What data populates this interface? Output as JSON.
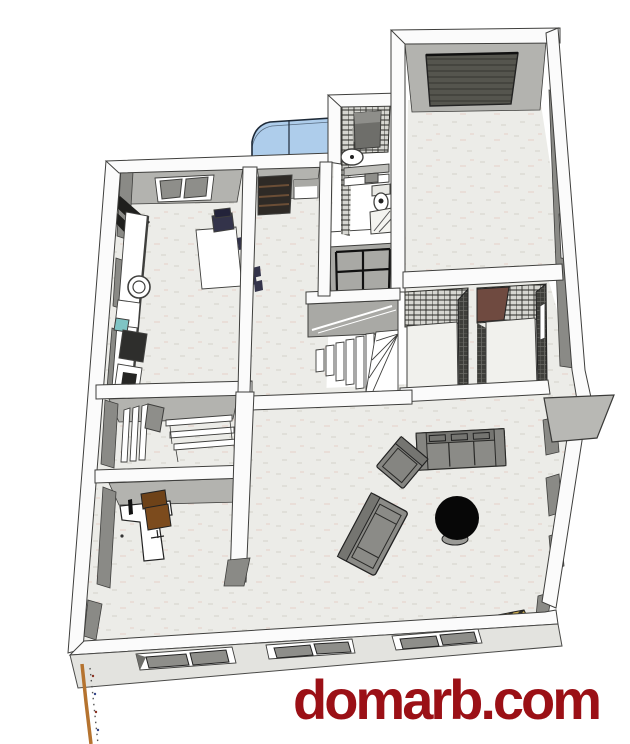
{
  "watermark": {
    "text": "domarb.com"
  },
  "colors": {
    "wall": "#fbfbfb",
    "line": "#3f3f3d",
    "floor": "#ececе8",
    "floorFix": "#ecece8",
    "floorSpeck": "#e0dfd9",
    "floorWarm": "#e9ded8",
    "faceMid": "#b3b3af",
    "faceDark": "#8a8a86",
    "faceDarker": "#6e6e6a",
    "garageDoor": "#55554e",
    "garageDoorRib": "#45453f",
    "tile": "#d6d6d1",
    "tileLine": "#2b2b27",
    "tileDarkWall": "#3e3e3a",
    "tileDarkLine": "#6b6b66",
    "bay": "#aecdeb",
    "bayLine": "#1e2a38",
    "navy": "#33334a",
    "teal": "#7fc4c4",
    "stove": "#2e2e2c",
    "chairBrown": "#7c4b1d",
    "chairBrownDark": "#6e4218",
    "brownPatch": "#6f4a40",
    "sofa": "#8b8b87",
    "sofaDark": "#757571",
    "armchair": "#858581",
    "canopy": "#b8b8b4",
    "facade": "#e3e3df",
    "gold": "#c9a94e",
    "goldDark": "#2f2f28",
    "watermark": "#9b1016",
    "orange": "#b5732f",
    "cabinet": "#a9a9a5",
    "landing": "#a9a9a5",
    "white": "#ffffff",
    "blackTable": "#070707",
    "paneGray": "#8e8e8a"
  }
}
